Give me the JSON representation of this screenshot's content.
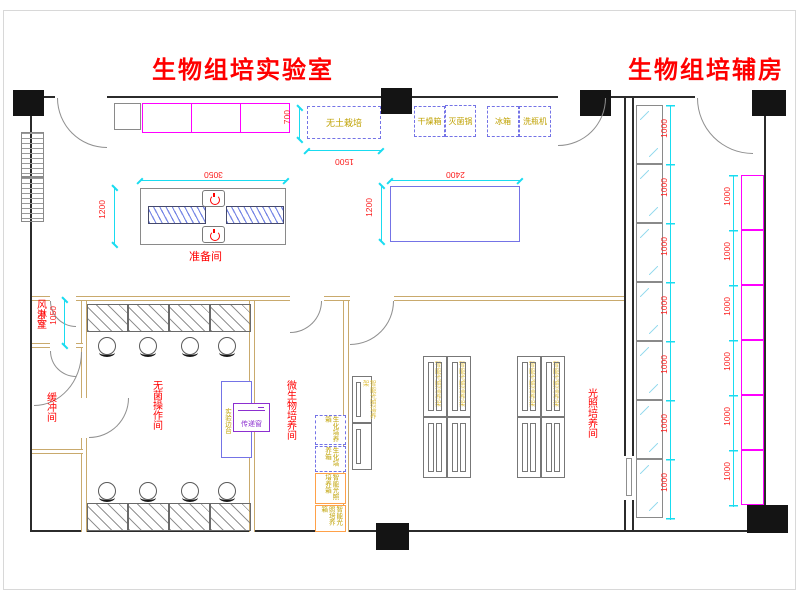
{
  "drawing": {
    "title_lab": "生物组培实验室",
    "title_aux": "生物组培辅房"
  },
  "rooms": {
    "prep": "准备间",
    "air_shower": "风淋室",
    "buffer": "缓冲间",
    "sterile": "无菌操作间",
    "micro": "微生物培养间",
    "light": "光照培养间"
  },
  "equipment": {
    "soilless": "无土栽培",
    "dryer": "干燥箱",
    "sterilizer": "灭菌锅",
    "fridge": "冰箱",
    "bottle_washer": "洗瓶机",
    "pass_window": "传递窗",
    "side_bench": "实验边台",
    "bio_incubator": "生化培养箱",
    "light_incubator": "智能光照培养箱",
    "light_rack": "智能光照培养架"
  },
  "dimensions": {
    "d700": "700",
    "d1500": "1500",
    "d3050": "3050",
    "d1200": "1200",
    "d2400": "2400",
    "d1050": "1050",
    "d1000": "1000"
  },
  "colors": {
    "title_red": "#ff0000",
    "dimension_red": "#fb2020",
    "dimension_cyan": "#19dcf0",
    "cabinet_magenta": "#ff00ff",
    "equipment_blue": "#7473e6",
    "pass_window_purple": "#8c2fd0",
    "equipment_label_olive": "#bfa100",
    "incubator_orange": "#ffa149",
    "partition_tan": "#c9aa6d",
    "wall_black": "#2b2b2b"
  }
}
